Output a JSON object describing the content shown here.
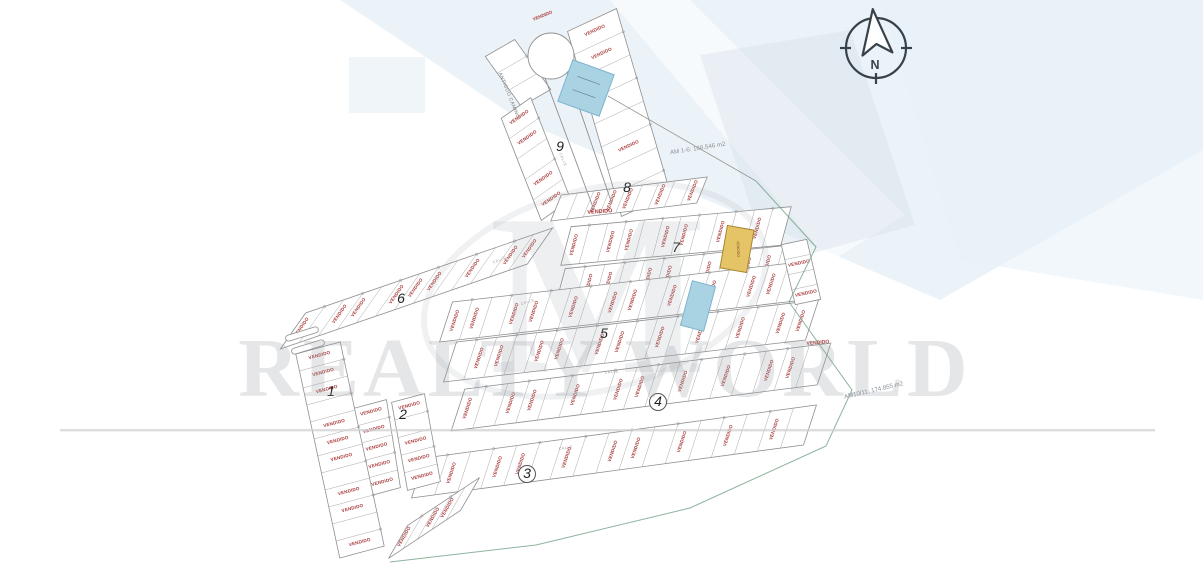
{
  "page": {
    "w": 1203,
    "h": 569,
    "bg": "#ffffff"
  },
  "labels": {
    "sold": "VENDIDO",
    "street": "ANTIGUO CAMINO",
    "road": "CALLE"
  },
  "compass": {
    "label": "N"
  },
  "watermark": {
    "brand": "REALTY WORLD",
    "monogram": "M"
  },
  "annotations": [
    {
      "text": "AM 1-6: 166.546 m2",
      "x": 698,
      "y": 150,
      "rot": -9
    },
    {
      "text": "AM10/11: 174.855 m2",
      "x": 874,
      "y": 392,
      "rot": -13
    }
  ],
  "blocks": [
    {
      "n": "1",
      "x": 331,
      "y": 396,
      "c": false
    },
    {
      "n": "2",
      "x": 403,
      "y": 419,
      "c": false
    },
    {
      "n": "3",
      "x": 527,
      "y": 478,
      "c": true
    },
    {
      "n": "4",
      "x": 658,
      "y": 406,
      "c": true
    },
    {
      "n": "5",
      "x": 604,
      "y": 338,
      "c": false
    },
    {
      "n": "6",
      "x": 401,
      "y": 303,
      "c": false
    },
    {
      "n": "7",
      "x": 676,
      "y": 252,
      "c": false
    },
    {
      "n": "8",
      "x": 627,
      "y": 192,
      "c": false
    },
    {
      "n": "9",
      "x": 560,
      "y": 151,
      "c": false
    }
  ],
  "strips": [
    {
      "id": "9T",
      "p1": [
        500,
        48
      ],
      "p2": [
        536,
        98
      ],
      "w": 34,
      "n": 3,
      "ta": -30,
      "sold": []
    },
    {
      "id": "9L",
      "p1": [
        516,
        108
      ],
      "p2": [
        556,
        210
      ],
      "w": 36,
      "n": 5,
      "ta": -35,
      "sold": [
        0,
        1,
        3,
        4
      ]
    },
    {
      "id": "9R",
      "p1": [
        592,
        20
      ],
      "p2": [
        646,
        205
      ],
      "w": 54,
      "n": 8,
      "ta": -25,
      "sold": [
        0,
        1,
        5,
        7
      ]
    },
    {
      "id": "8",
      "p1": [
        556,
        208
      ],
      "p2": [
        702,
        190
      ],
      "w": 28,
      "n": 9,
      "ta": -68,
      "sold": [
        2,
        3,
        4,
        6,
        8
      ]
    },
    {
      "id": "7a",
      "p1": [
        566,
        246
      ],
      "p2": [
        786,
        226
      ],
      "w": 40,
      "n": 12,
      "ta": -75,
      "sold": [
        0,
        2,
        3,
        5,
        6,
        8,
        10
      ]
    },
    {
      "id": "7b",
      "p1": [
        560,
        288
      ],
      "p2": [
        798,
        263
      ],
      "w": 40,
      "n": 12,
      "ta": -75,
      "sold": [
        1,
        2,
        4,
        5,
        7,
        9,
        10
      ]
    },
    {
      "id": "6",
      "p1": [
        293,
        331
      ],
      "p2": [
        540,
        246
      ],
      "w": 44,
      "n": 13,
      "ta": -55,
      "sold": [
        0,
        2,
        3,
        5,
        6,
        7,
        9,
        11,
        12
      ]
    },
    {
      "id": "5a",
      "p1": [
        446,
        322
      ],
      "p2": [
        802,
        281
      ],
      "w": 42,
      "n": 18,
      "ta": -72,
      "sold": [
        0,
        1,
        3,
        4,
        6,
        8,
        9,
        11,
        13,
        15,
        16
      ]
    },
    {
      "id": "5b",
      "p1": [
        450,
        362
      ],
      "p2": [
        812,
        320
      ],
      "w": 42,
      "n": 18,
      "ta": -72,
      "sold": [
        1,
        2,
        4,
        5,
        7,
        8,
        10,
        12,
        14,
        16,
        17
      ]
    },
    {
      "id": "R1",
      "p1": [
        794,
        242
      ],
      "p2": [
        808,
        302
      ],
      "w": 26,
      "n": 4,
      "ta": -12,
      "sold": [
        1,
        3
      ]
    },
    {
      "id": "4a",
      "p1": [
        458,
        410
      ],
      "p2": [
        824,
        364
      ],
      "w": 44,
      "n": 17,
      "ta": -72,
      "sold": [
        0,
        2,
        3,
        5,
        7,
        8,
        10,
        12,
        14,
        15
      ]
    },
    {
      "id": "3a",
      "p1": [
        418,
        478
      ],
      "p2": [
        810,
        425
      ],
      "w": 42,
      "n": 17,
      "ta": -72,
      "sold": [
        1,
        3,
        4,
        6,
        8,
        9,
        11,
        13,
        15
      ]
    },
    {
      "id": "3t",
      "p1": [
        398,
        542
      ],
      "p2": [
        470,
        494
      ],
      "w": 38,
      "n": 5,
      "ta": -60,
      "sold": [
        0,
        2,
        3
      ]
    },
    {
      "id": "2a",
      "p1": [
        370,
        404
      ],
      "p2": [
        384,
        492
      ],
      "w": 34,
      "n": 5,
      "ta": -15,
      "sold": [
        0,
        1,
        2,
        3,
        4
      ]
    },
    {
      "id": "2b",
      "p1": [
        408,
        398
      ],
      "p2": [
        424,
        486
      ],
      "w": 34,
      "n": 5,
      "ta": -15,
      "sold": [
        0,
        2,
        3,
        4
      ]
    },
    {
      "id": "1",
      "p1": [
        318,
        348
      ],
      "p2": [
        362,
        552
      ],
      "w": 46,
      "n": 12,
      "ta": -15,
      "sold": [
        0,
        1,
        2,
        4,
        5,
        6,
        8,
        9,
        11
      ]
    }
  ],
  "highlights": [
    {
      "name": "lot-highlight-blue-top",
      "x": 586,
      "y": 88,
      "w": 44,
      "h": 44,
      "rot": 20,
      "fill": "#a9d2e3",
      "stroke": "#7fb4cd",
      "label": "",
      "dims_lines": true
    },
    {
      "name": "lot-highlight-blue-mid",
      "x": 698,
      "y": 306,
      "w": 24,
      "h": 46,
      "rot": 15,
      "fill": "#a9d2e3",
      "stroke": "#7fb4cd",
      "label": "",
      "dims_lines": false
    },
    {
      "name": "lot-highlight-yellow",
      "x": 737,
      "y": 249,
      "w": 27,
      "h": 43,
      "rot": 10,
      "fill": "#e5c468",
      "stroke": "#a6862e",
      "label": "VENDIDO",
      "dims_lines": false
    }
  ],
  "extra_sold": [
    {
      "x": 600,
      "y": 213,
      "rot": -4,
      "fs": 5.5
    },
    {
      "x": 818,
      "y": 344,
      "rot": -5,
      "fs": 5
    },
    {
      "x": 543,
      "y": 17,
      "rot": -22,
      "fs": 4.5
    }
  ],
  "calle_labels": [
    {
      "x": 528,
      "y": 303,
      "rot": -16
    },
    {
      "x": 612,
      "y": 373,
      "rot": -7
    },
    {
      "x": 566,
      "y": 449,
      "rot": -8
    },
    {
      "x": 562,
      "y": 160,
      "rot": 68
    },
    {
      "x": 500,
      "y": 261,
      "rot": -20
    }
  ],
  "cul_de_sac": {
    "cx": 551,
    "cy": 56,
    "r": 23,
    "stems": [
      [
        545,
        78,
        594,
        210
      ],
      [
        567,
        72,
        612,
        204
      ]
    ]
  },
  "entrance_arrows": [
    {
      "x": 302,
      "y": 334,
      "rot": -17
    },
    {
      "x": 308,
      "y": 347,
      "rot": -17
    }
  ],
  "boundary": {
    "green": [
      [
        756,
        181
      ],
      [
        816,
        247
      ],
      [
        789,
        302
      ],
      [
        852,
        390
      ],
      [
        826,
        446
      ],
      [
        690,
        508
      ],
      [
        536,
        545
      ],
      [
        390,
        562
      ]
    ],
    "gray": [
      [
        608,
        96
      ],
      [
        756,
        181
      ]
    ],
    "green_color": "#69997d"
  },
  "colors": {
    "sold": "#a93a3a",
    "line": "#8f8f8f",
    "divider": "#a8a8a8",
    "number": "#1f1f1f",
    "annotation": "#8b9197",
    "watermark": "#9aa2a8",
    "compass": "#37424a"
  }
}
